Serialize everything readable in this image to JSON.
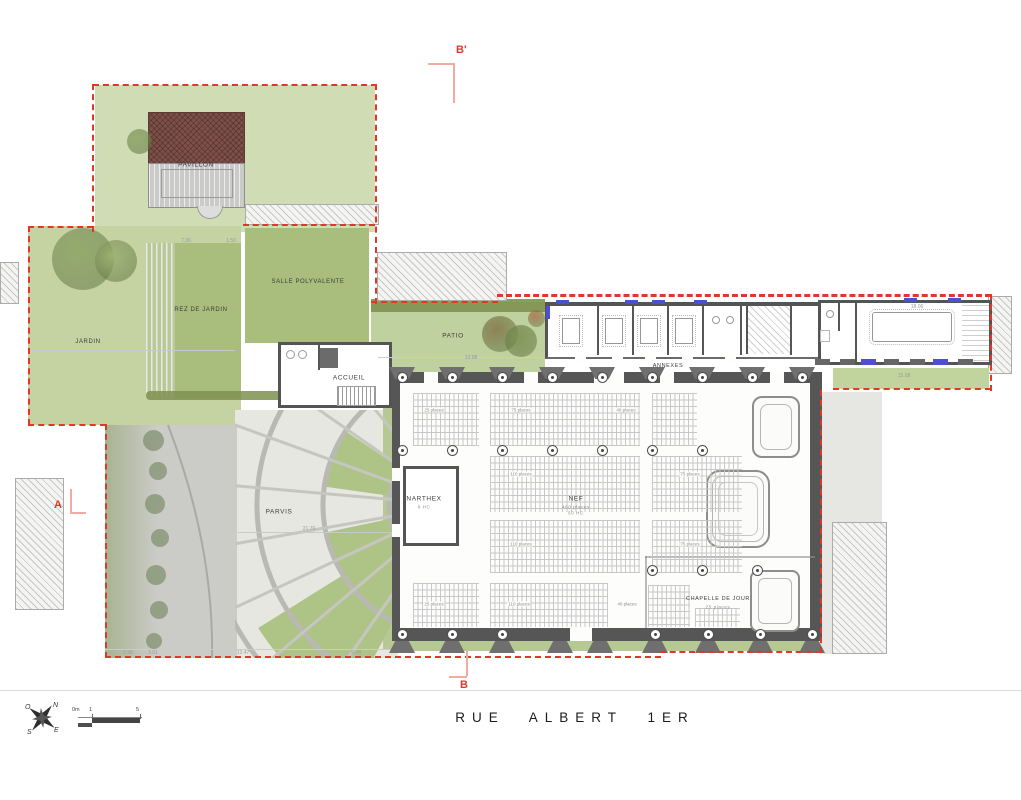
{
  "street": {
    "name": "RUE ALBERT 1ER"
  },
  "markers": {
    "a": "A",
    "b": "B",
    "b_prime": "B'"
  },
  "compass": {
    "n": "N",
    "e": "E",
    "s": "S",
    "o": "O"
  },
  "scale_bar": {
    "zero": "0m",
    "one": "1",
    "five": "5"
  },
  "plan": {
    "labels": [
      {
        "id": "pavillon",
        "t": "PAVILLON",
        "x": 196,
        "y": 165,
        "s": 6.5
      },
      {
        "id": "salle-polyvalente",
        "t": "SALLE POLYVALENTE",
        "x": 308,
        "y": 282,
        "s": 6
      },
      {
        "id": "rez-de-jardin",
        "t": "REZ DE JARDIN",
        "x": 201,
        "y": 310,
        "s": 6
      },
      {
        "id": "jardin",
        "t": "JARDIN",
        "x": 88,
        "y": 342,
        "s": 6
      },
      {
        "id": "patio",
        "t": "PATIO",
        "x": 453,
        "y": 336,
        "s": 6.5
      },
      {
        "id": "accueil",
        "t": "ACCUEIL",
        "x": 349,
        "y": 378,
        "s": 6.5
      },
      {
        "id": "annexes",
        "t": "ANNEXES",
        "x": 668,
        "y": 366,
        "s": 5.5
      },
      {
        "id": "narthex",
        "t": "NARTHEX",
        "x": 424,
        "y": 499,
        "s": 6.5
      },
      {
        "id": "narthex-sub",
        "t": "8 HC",
        "x": 424,
        "y": 507,
        "s": 4.5,
        "c": "#8a8a8a"
      },
      {
        "id": "nef",
        "t": "NEF",
        "x": 576,
        "y": 499,
        "s": 6.5
      },
      {
        "id": "nef-places",
        "t": "460 places",
        "x": 576,
        "y": 507,
        "s": 4.5,
        "c": "#8a8a8a"
      },
      {
        "id": "nef-hc",
        "t": "50 HC",
        "x": 576,
        "y": 513,
        "s": 4.5,
        "c": "#8a8a8a"
      },
      {
        "id": "chapelle-de-jour",
        "t": "CHAPELLE DE JOUR",
        "x": 718,
        "y": 599,
        "s": 5.5
      },
      {
        "id": "chapelle-places",
        "t": "25 places",
        "x": 718,
        "y": 607,
        "s": 4.5,
        "c": "#8a8a8a"
      },
      {
        "id": "parvis",
        "t": "PARVIS",
        "x": 279,
        "y": 512,
        "s": 6.5
      }
    ],
    "place_counts": [
      {
        "t": "25 places",
        "x": 434,
        "y": 410
      },
      {
        "t": "75 places",
        "x": 521,
        "y": 410
      },
      {
        "t": "40 places",
        "x": 626,
        "y": 410
      },
      {
        "t": "110 places",
        "x": 521,
        "y": 474
      },
      {
        "t": "75 places",
        "x": 690,
        "y": 474
      },
      {
        "t": "110 places",
        "x": 521,
        "y": 544
      },
      {
        "t": "75 places",
        "x": 690,
        "y": 544
      },
      {
        "t": "25 places",
        "x": 434,
        "y": 604
      },
      {
        "t": "110 places",
        "x": 519,
        "y": 604
      },
      {
        "t": "40 places",
        "x": 627,
        "y": 604
      }
    ],
    "dims": [
      {
        "t": "7.36",
        "x": 186,
        "y": 241
      },
      {
        "t": "1.50",
        "x": 231,
        "y": 241
      },
      {
        "t": "2.98",
        "x": 128,
        "y": 653
      },
      {
        "t": "3.01",
        "x": 153,
        "y": 653
      },
      {
        "t": "13.47",
        "x": 243,
        "y": 653
      },
      {
        "t": "9.48",
        "x": 356,
        "y": 653
      },
      {
        "t": "21.70",
        "x": 309,
        "y": 529
      },
      {
        "t": "13.08",
        "x": 471,
        "y": 358
      },
      {
        "t": "15.08",
        "x": 904,
        "y": 376
      },
      {
        "t": "18.06",
        "x": 917,
        "y": 307
      }
    ],
    "pews": [
      [
        413,
        393,
        66,
        53
      ],
      [
        490,
        393,
        150,
        53
      ],
      [
        652,
        393,
        45,
        53
      ],
      [
        490,
        456,
        150,
        56
      ],
      [
        652,
        456,
        90,
        56
      ],
      [
        490,
        520,
        150,
        53
      ],
      [
        652,
        520,
        90,
        53
      ],
      [
        413,
        583,
        66,
        44
      ],
      [
        490,
        583,
        118,
        44
      ],
      [
        648,
        585,
        42,
        42
      ],
      [
        695,
        608,
        45,
        19
      ]
    ],
    "columns": [
      {
        "y": 377,
        "xs": [
          402,
          452,
          502,
          552,
          602,
          652,
          702,
          752,
          802
        ]
      },
      {
        "y": 450,
        "xs": [
          402,
          452,
          502,
          552,
          602,
          652,
          702
        ]
      },
      {
        "y": 570,
        "xs": [
          652,
          702,
          757
        ]
      },
      {
        "y": 634,
        "xs": [
          402,
          452,
          502,
          655,
          708,
          760,
          812
        ]
      }
    ],
    "caps": {
      "top": {
        "y": 367,
        "xs": [
          402,
          452,
          502,
          552,
          602,
          652,
          702,
          752,
          802
        ]
      },
      "bottom": {
        "y": 641,
        "xs": [
          402,
          452,
          502,
          560,
          600,
          655,
          708,
          760,
          812
        ]
      }
    },
    "gaps": [
      [
        424,
        372,
        14,
        11
      ],
      [
        524,
        372,
        14,
        11
      ],
      [
        594,
        372,
        30,
        11
      ],
      [
        660,
        372,
        14,
        11
      ],
      [
        770,
        372,
        14,
        11
      ],
      [
        570,
        628,
        22,
        13
      ],
      [
        392,
        468,
        8,
        13
      ],
      [
        392,
        524,
        8,
        13
      ],
      [
        575,
        355,
        11,
        6
      ],
      [
        612,
        355,
        11,
        6
      ],
      [
        645,
        355,
        11,
        6
      ],
      [
        682,
        355,
        11,
        6
      ],
      [
        725,
        355,
        11,
        6
      ]
    ],
    "annex_dividers": [
      597,
      632,
      667,
      702,
      740,
      790
    ],
    "tables": [
      [
        571,
        331
      ],
      [
        614,
        331
      ],
      [
        649,
        331
      ],
      [
        684,
        331
      ]
    ],
    "trees": [
      [
        52,
        228,
        62,
        "#8ea766",
        0.9
      ],
      [
        95,
        240,
        42,
        "#9db273",
        0.9
      ],
      [
        127,
        129,
        25,
        "#93aa6b",
        0.95
      ],
      [
        482,
        316,
        36,
        "#8a7a4d",
        0.9
      ],
      [
        505,
        325,
        32,
        "#7c9151",
        0.9
      ],
      [
        528,
        310,
        17,
        "#b26b49",
        0.8
      ],
      [
        143,
        430,
        21,
        "#87997a",
        0.85
      ],
      [
        149,
        462,
        18,
        "#87997a",
        0.85
      ],
      [
        145,
        494,
        20,
        "#87997a",
        0.85
      ],
      [
        151,
        529,
        18,
        "#87997a",
        0.85
      ],
      [
        146,
        565,
        20,
        "#87997a",
        0.85
      ],
      [
        150,
        601,
        18,
        "#87997a",
        0.85
      ],
      [
        146,
        633,
        16,
        "#87997a",
        0.85
      ]
    ],
    "benches": [
      {
        "x": 815
      },
      {
        "x": 840
      },
      {
        "x": 861,
        "b": 1
      },
      {
        "x": 884
      },
      {
        "x": 910
      },
      {
        "x": 933,
        "b": 1
      },
      {
        "x": 958
      }
    ],
    "window_ticks": [
      [
        556,
        300,
        13,
        4
      ],
      [
        625,
        300,
        13,
        4
      ],
      [
        652,
        300,
        13,
        4
      ],
      [
        694,
        300,
        13,
        4
      ],
      [
        904,
        298,
        13,
        4
      ],
      [
        948,
        298,
        13,
        4
      ],
      [
        546,
        306,
        4,
        13
      ]
    ],
    "boundary": [
      {
        "x": 93,
        "y": 84,
        "l": 284,
        "o": "h"
      },
      {
        "x": 92,
        "y": 84,
        "l": 148,
        "o": "v"
      },
      {
        "x": 28,
        "y": 226,
        "l": 65,
        "o": "h"
      },
      {
        "x": 28,
        "y": 226,
        "l": 199,
        "o": "v"
      },
      {
        "x": 28,
        "y": 424,
        "l": 78,
        "o": "h"
      },
      {
        "x": 105,
        "y": 424,
        "l": 234,
        "o": "v"
      },
      {
        "x": 105,
        "y": 656,
        "l": 556,
        "o": "h"
      },
      {
        "x": 375,
        "y": 84,
        "l": 220,
        "o": "v"
      },
      {
        "x": 243,
        "y": 224,
        "l": 132,
        "o": "h"
      },
      {
        "x": 371,
        "y": 301,
        "l": 127,
        "o": "h"
      },
      {
        "x": 497,
        "y": 294,
        "l": 494,
        "o": "h",
        "heavy": 1
      },
      {
        "x": 990,
        "y": 294,
        "l": 97,
        "o": "v"
      },
      {
        "x": 833,
        "y": 388,
        "l": 158,
        "o": "h"
      },
      {
        "x": 820,
        "y": 390,
        "l": 263,
        "o": "v"
      },
      {
        "x": 660,
        "y": 651,
        "l": 161,
        "o": "h"
      }
    ],
    "parvis": {
      "cx": 455,
      "cy": 505,
      "r0": 26,
      "rings": [
        66,
        132,
        198,
        250
      ],
      "ringStroke": "#b9b9b3",
      "ringW": 5,
      "spokes": {
        "from": 95,
        "to": 260,
        "step": 15,
        "r1": 30,
        "r2": 248,
        "stroke": "#c6c6c1",
        "w": 3
      },
      "wedges": [
        {
          "a1": 188,
          "a2": 214,
          "r1": 64,
          "r2": 130
        },
        {
          "a1": 146,
          "a2": 168,
          "r1": 64,
          "r2": 130
        },
        {
          "a1": 118,
          "a2": 148,
          "r1": 72,
          "r2": 232
        }
      ],
      "wedgeFill": "#aec487"
    },
    "colors": {
      "boundary_red": "#df382b",
      "section_salmon": "#f3aaa1",
      "window_blue": "#4d4dd6",
      "lawn_light": "#cfdcb4",
      "lawn_dark": "#a9bd7c",
      "paving": "#e7e7e2",
      "wall_gray": "#565656",
      "roof_brown": "#7d5048"
    }
  }
}
